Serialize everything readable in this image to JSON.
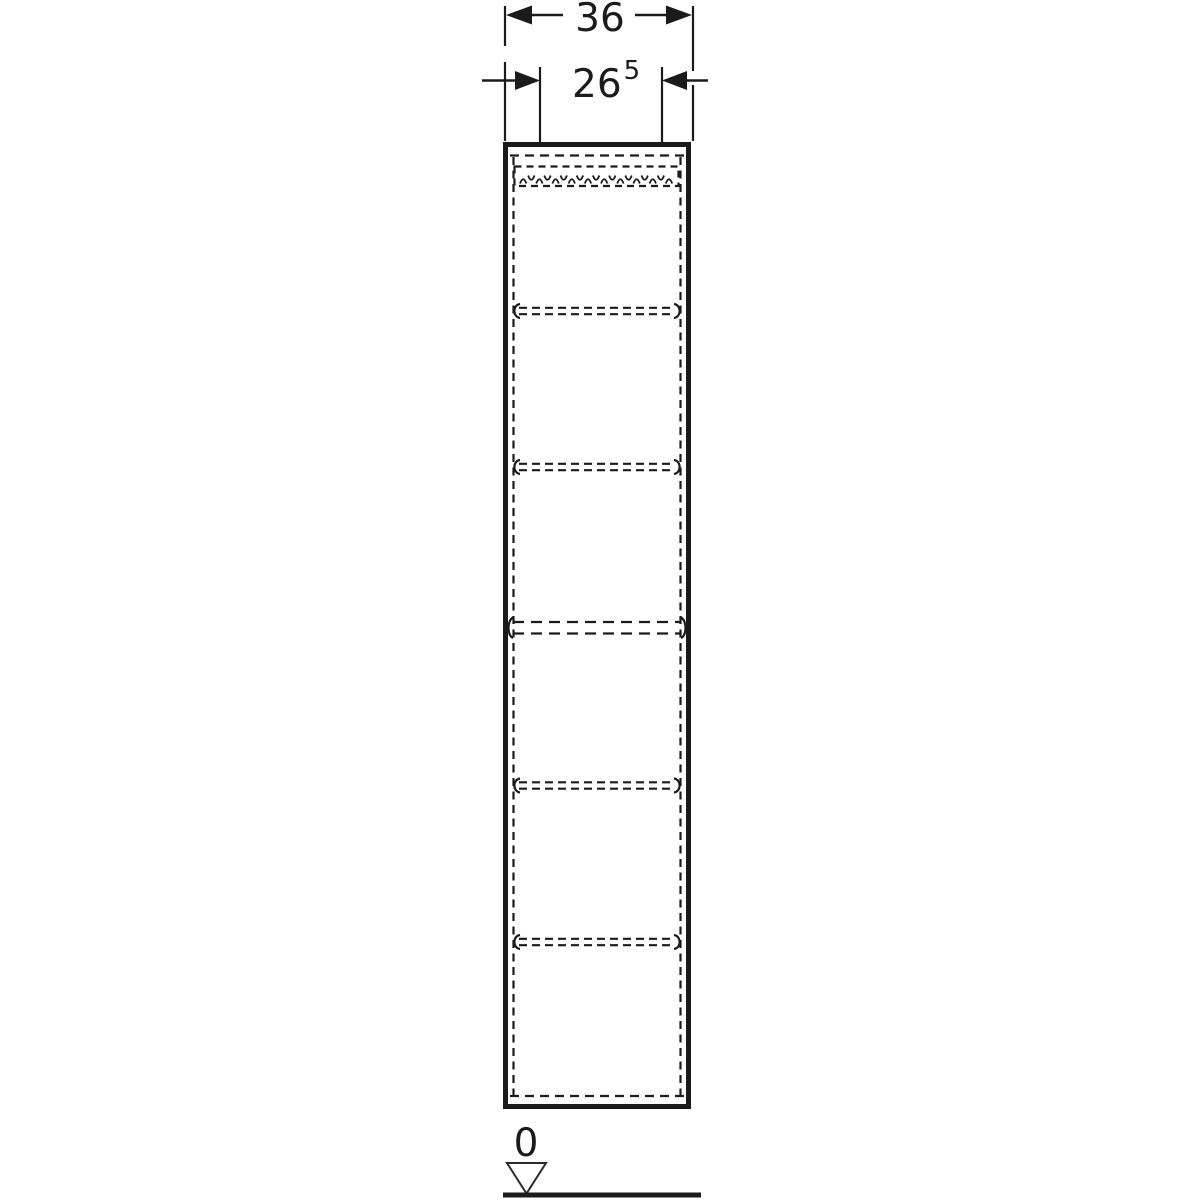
{
  "figure": {
    "type": "furniture-technical-drawing",
    "description": "Front elevation of a tall cabinet with dashed shelf lines, width dimensions and floor datum",
    "line_color": "#1b1b1b",
    "background_color": "#ffffff"
  },
  "dimensions": {
    "outer_width_label": "36",
    "inner_width_label_main": "26",
    "inner_width_label_sup": "5"
  },
  "datum": {
    "label": "0"
  }
}
